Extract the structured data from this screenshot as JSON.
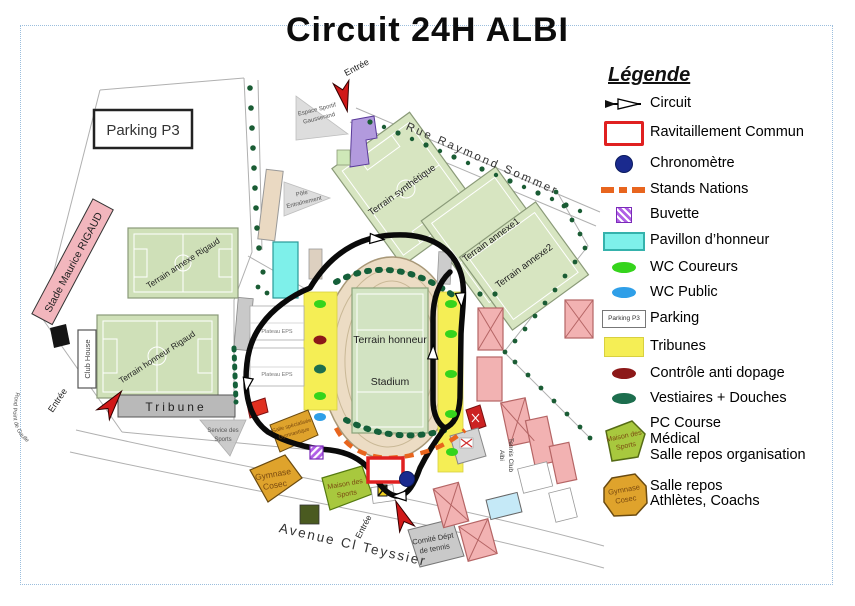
{
  "title": "Circuit 24H ALBI",
  "map": {
    "parking_p3": "Parking P3",
    "stade_maurice_rigaud": "Stade Maurice RIGAUD",
    "terrain_annexe_rigaud": "Terrain annexe Rigaud",
    "terrain_honneur_rigaud": "Terrain honneur Rigaud",
    "club_house": "Club House",
    "tribune": "Tribune",
    "terrain_synthetique": "Terrain synthétique",
    "terrain_annexe1": "Terrain annexe1",
    "terrain_annexe2": "Terrain annexe2",
    "rue_raymond_sommer": "Rue Raymond Sommer",
    "avenue_cl_teyssier": "Avenue Cl Teyssier",
    "espace_sportif_1": "Espace Sportif",
    "espace_sportif_2": "Gausserand",
    "pole_1": "Pôle",
    "pole_2": "Entraînement",
    "service_1": "Service des",
    "service_2": "Sports",
    "stadium_1": "Terrain honneur",
    "stadium_2": "Stadium",
    "plateau_eps": "Plateau EPS",
    "entree": "Entrée",
    "rond_point": "Rond Point de Gaulle",
    "salle_gym_1": "Salle spécialisée",
    "salle_gym_2": "Gymnastique",
    "gymnase_1": "Gymnase",
    "gymnase_2": "Cosec",
    "maison_1": "Maison des",
    "maison_2": "Sports",
    "comite_1": "Comité Dépt",
    "comite_2": "de tennis",
    "tennis_club_1": "Tennis Club",
    "tennis_club_2": "Albi"
  },
  "legend": {
    "title": "Légende",
    "items": [
      {
        "label": "Circuit"
      },
      {
        "label": "Ravitaillement Commun"
      },
      {
        "label": "Chronomètre"
      },
      {
        "label": "Stands Nations"
      },
      {
        "label": "Buvette"
      },
      {
        "label": "Pavillon d’honneur"
      },
      {
        "label": "WC Coureurs"
      },
      {
        "label": "WC Public"
      },
      {
        "label": "Parking",
        "icon_text": "Parking P3"
      },
      {
        "label": "Tribunes"
      },
      {
        "label": "Contrôle anti dopage"
      },
      {
        "label": "Vestiaires + Douches"
      },
      {
        "label_lines": [
          "PC Course",
          "Médical",
          "Salle repos organisation"
        ],
        "icon_line1": "Maison des",
        "icon_line2": "Sports"
      },
      {
        "label_lines": [
          "Salle repos",
          "Athlètes, Coachs"
        ],
        "icon_line1": "Gymnase",
        "icon_line2": "Cosec"
      }
    ],
    "colors": {
      "circuit": "#000000",
      "ravitaillement": "#e02020",
      "chronometre": "#1a2a8e",
      "stands_nations": "#e8651e",
      "buvette": "#b05fe6",
      "pavillon": "#7ef0ea",
      "wc_coureurs": "#35d41c",
      "wc_public": "#2f9fe8",
      "tribunes": "#f5ee55",
      "controle_anti_dopage": "#8c1818",
      "vestiaires": "#1d6e4e",
      "pc_course": "#a8c83e",
      "salle_repos": "#dfa32c"
    }
  }
}
